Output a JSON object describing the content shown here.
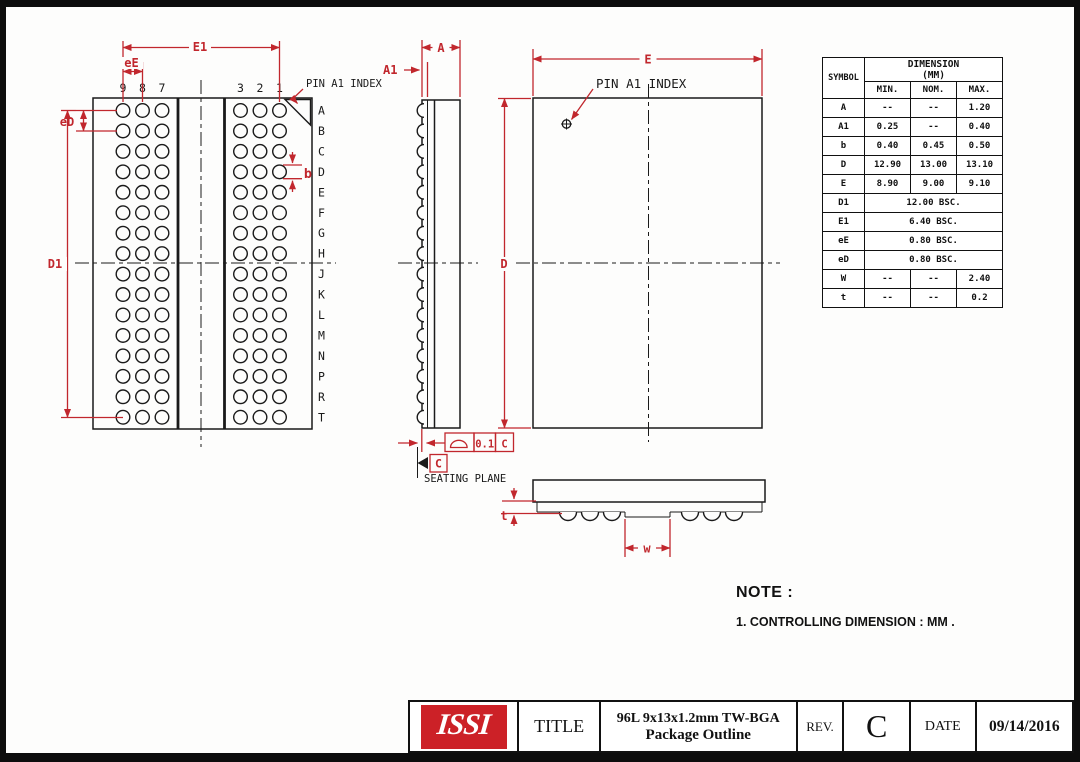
{
  "colors": {
    "dimension_red": "#c1272d",
    "logo_red": "#cc2127",
    "line_black": "#1a1a1a"
  },
  "left_view": {
    "pin_a1": "PIN A1 INDEX",
    "col_labels": [
      "9",
      "8",
      "7",
      "3",
      "2",
      "1"
    ],
    "row_labels": [
      "A",
      "B",
      "C",
      "D",
      "E",
      "F",
      "G",
      "H",
      "J",
      "K",
      "L",
      "M",
      "N",
      "P",
      "R",
      "T"
    ],
    "dim_e1": "E1",
    "dim_ee": "eE",
    "dim_ed": "eD",
    "dim_d1": "D1",
    "dim_b": "b"
  },
  "side_view": {
    "dim_a": "A",
    "dim_a1": "A1",
    "flatness_tolerance": "0.1",
    "flatness_datum": "C",
    "datum_label": "C",
    "seating_plane": "SEATING PLANE"
  },
  "top_view": {
    "pin_a1": "PIN A1 INDEX",
    "dim_e": "E",
    "dim_d": "D"
  },
  "profile_view": {
    "dim_t": "t",
    "dim_w": "w"
  },
  "table": {
    "symbol_header": "SYMBOL",
    "dim_header": "DIMENSION",
    "dim_unit": "(MM)",
    "cols": [
      "MIN.",
      "NOM.",
      "MAX."
    ],
    "rows": [
      {
        "sym": "A",
        "min": "--",
        "nom": "--",
        "max": "1.20"
      },
      {
        "sym": "A1",
        "min": "0.25",
        "nom": "--",
        "max": "0.40"
      },
      {
        "sym": "b",
        "min": "0.40",
        "nom": "0.45",
        "max": "0.50"
      },
      {
        "sym": "D",
        "min": "12.90",
        "nom": "13.00",
        "max": "13.10"
      },
      {
        "sym": "E",
        "min": "8.90",
        "nom": "9.00",
        "max": "9.10"
      },
      {
        "sym": "D1",
        "merged": "12.00 BSC."
      },
      {
        "sym": "E1",
        "merged": "6.40 BSC."
      },
      {
        "sym": "eE",
        "merged": "0.80 BSC."
      },
      {
        "sym": "eD",
        "merged": "0.80 BSC."
      },
      {
        "sym": "W",
        "min": "--",
        "nom": "--",
        "max": "2.40"
      },
      {
        "sym": "t",
        "min": "--",
        "nom": "--",
        "max": "0.2"
      }
    ]
  },
  "note": {
    "heading": "NOTE :",
    "item1": "1. CONTROLLING DIMENSION : MM ."
  },
  "title_block": {
    "logo": "ISSI",
    "title_label": "TITLE",
    "title_line1": "96L 9x13x1.2mm TW-BGA",
    "title_line2": "Package Outline",
    "rev_label": "REV.",
    "rev_value": "C",
    "date_label": "DATE",
    "date_value": "09/14/2016"
  }
}
